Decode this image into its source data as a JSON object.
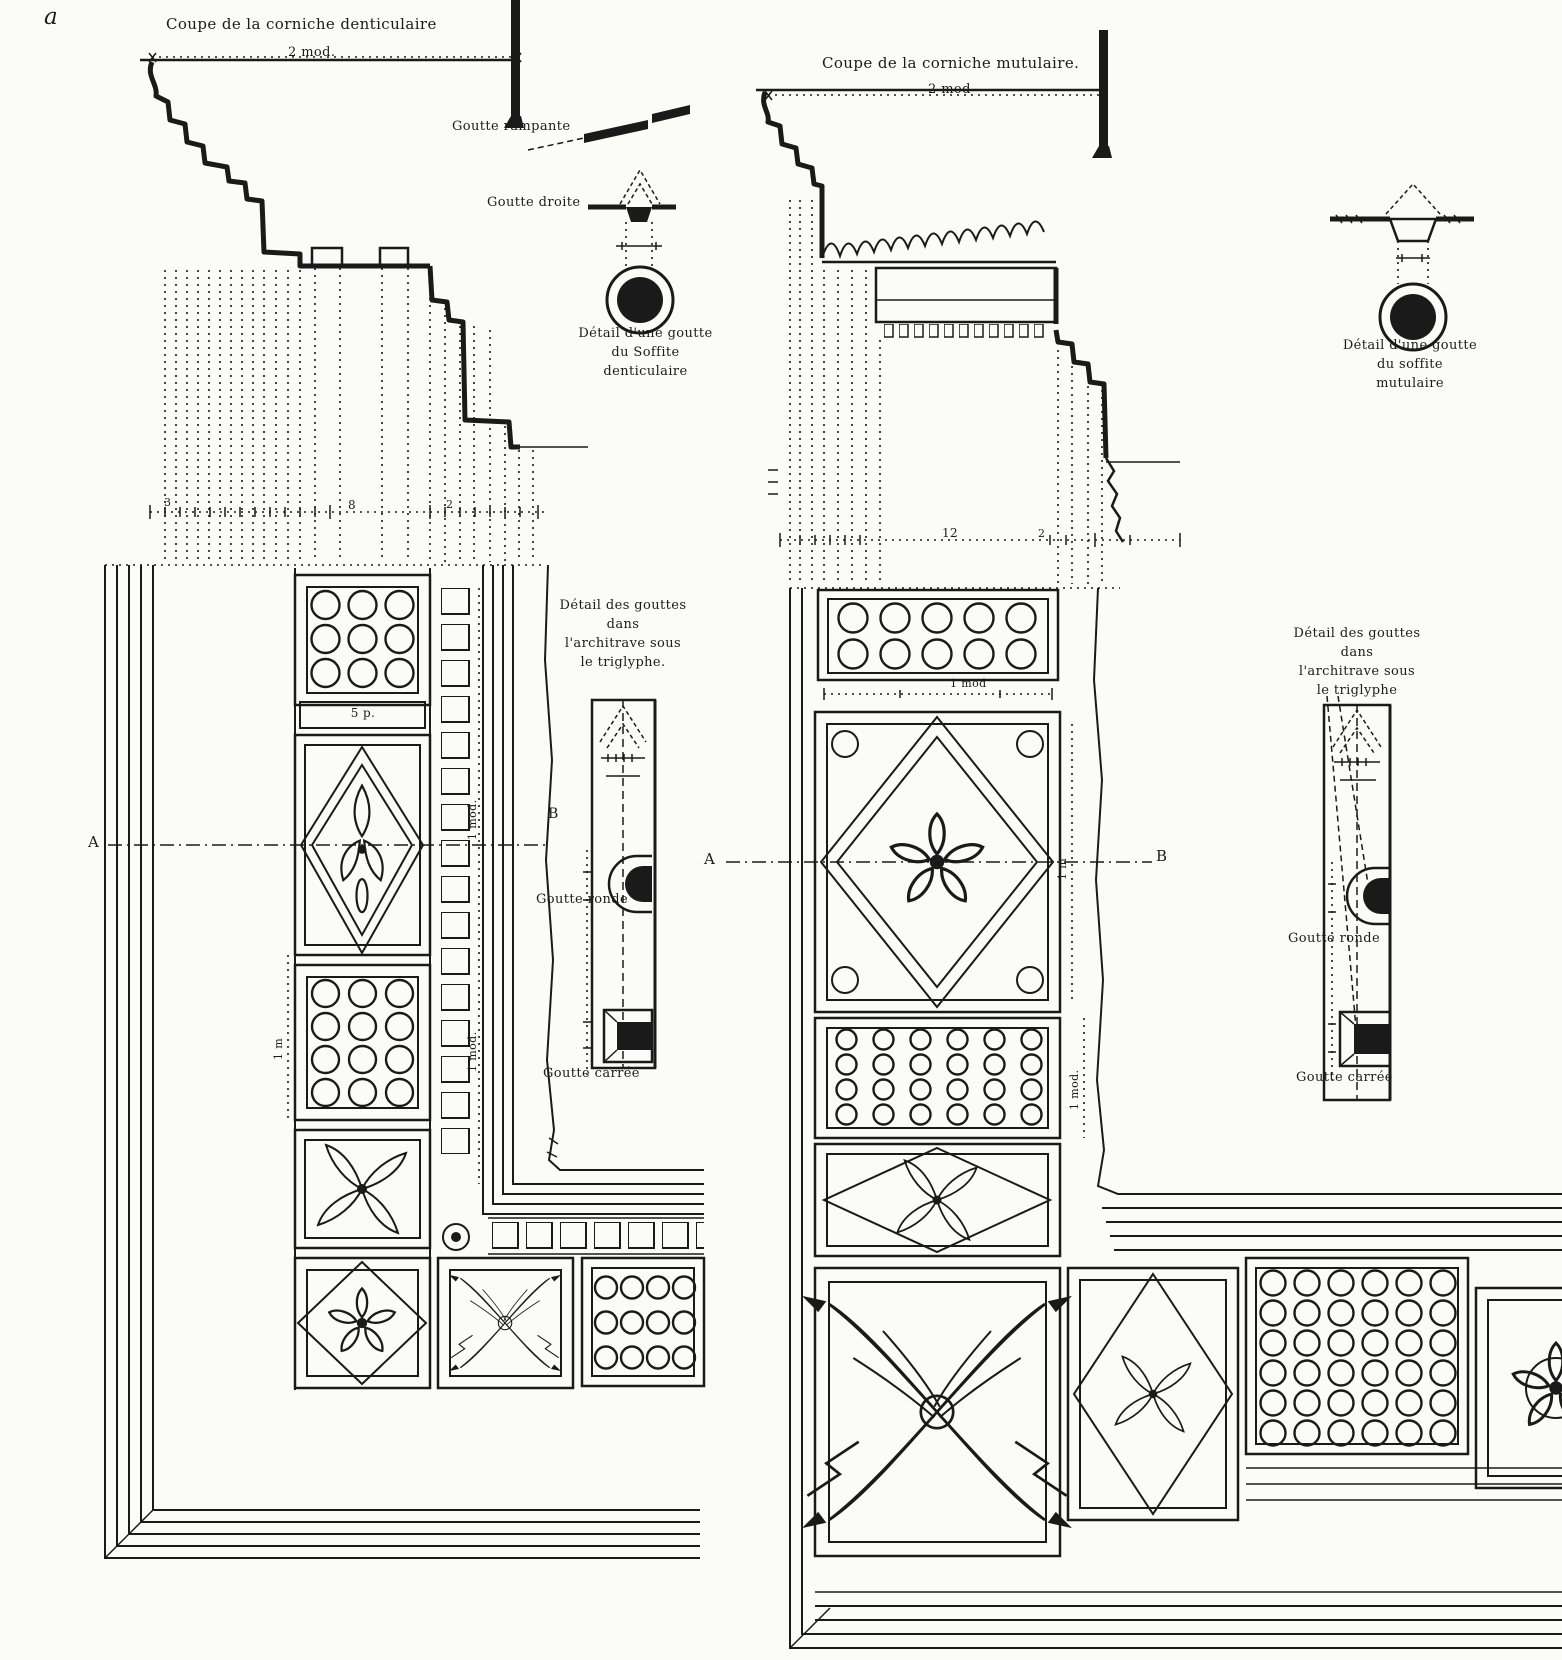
{
  "figure_label": "a",
  "left": {
    "title": "Coupe de la corniche denticulaire",
    "scale": "2 mod.",
    "goutte_rampante": "Goutte rampante",
    "goutte_droite": "Goutte droite",
    "goutta_detail": [
      "Détail d'une goutte",
      "du Soffite",
      "denticulaire"
    ],
    "triglyph_detail": [
      "Détail des gouttes",
      "dans",
      "l'architrave sous",
      "le triglyphe."
    ],
    "goutte_ronde": "Goutte ronde",
    "goutte_carree": "Goutte carrée",
    "marker_a": "A",
    "marker_b": "B",
    "dims": {
      "d3": "3",
      "d8": "8",
      "d2": "2",
      "p5": "5 p.",
      "mod1_upper": "1 mod.",
      "mod1_lower": "1 mod.",
      "m1": "1 m"
    }
  },
  "right": {
    "title": "Coupe de la corniche mutulaire.",
    "scale": "2 mod",
    "goutta_detail": [
      "Détail d'une goutte",
      "du soffite",
      "mutulaire"
    ],
    "triglyph_detail": [
      "Détail des gouttes",
      "dans",
      "l'architrave sous",
      "le triglyphe"
    ],
    "goutte_ronde": "Goutte ronde",
    "goutte_carree": "Goutte carrée",
    "marker_a": "A",
    "marker_b": "B",
    "dims": {
      "d12": "12",
      "d2": "2",
      "mod1": "1 mod",
      "m1": "1 m",
      "mod1_v": "1 mod."
    }
  },
  "ink_color": "#1a1a1a",
  "paper_color": "#fbfbf8"
}
